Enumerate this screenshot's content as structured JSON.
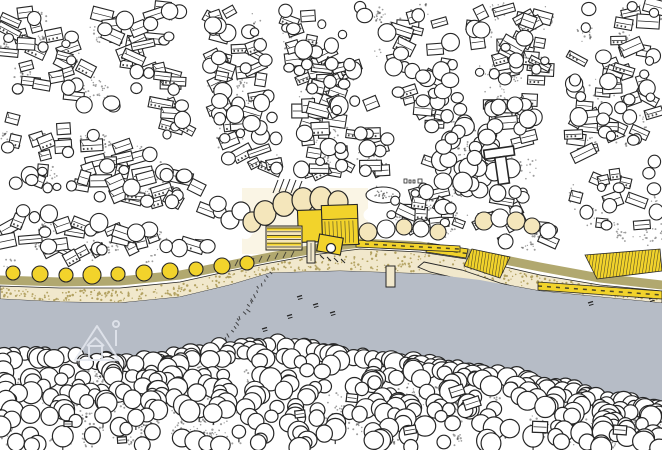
{
  "meta": {
    "width": 662,
    "height": 450,
    "kind": "hand-drawn-riverside-town-map"
  },
  "palette": {
    "ink": "#262626",
    "paper": "#ffffff",
    "river": "#b6bcc6",
    "yellow": "#f2d32b",
    "cream": "#f4e6bb",
    "creamTint": "#f7efd4",
    "sand": "#f1e8cc",
    "sandDot": "#b3a262",
    "olive": "#b1a86f",
    "stipple": "#3c3c3c",
    "street": "#ffffff",
    "watermark": "#e4e8ee"
  },
  "gen": {
    "seed": 11,
    "townBuildings": 300,
    "townTrees": 240,
    "stippleClumps": 160,
    "parkTrees": 26,
    "beachDots": 440,
    "southTrees": 360,
    "southStippleClumps": 95
  },
  "townBottom": [
    [
      0,
      271
    ],
    [
      60,
      271
    ],
    [
      120,
      269
    ],
    [
      180,
      262
    ],
    [
      230,
      253
    ],
    [
      270,
      245
    ],
    [
      320,
      237
    ],
    [
      360,
      233
    ],
    [
      420,
      237
    ],
    [
      480,
      246
    ],
    [
      540,
      258
    ],
    [
      600,
      268
    ],
    [
      662,
      274
    ]
  ],
  "roadPath": [
    [
      0,
      280
    ],
    [
      60,
      282
    ],
    [
      120,
      281
    ],
    [
      180,
      275
    ],
    [
      230,
      265
    ],
    [
      270,
      257
    ],
    [
      320,
      248
    ],
    [
      360,
      243
    ],
    [
      420,
      246
    ],
    [
      480,
      255
    ],
    [
      540,
      267
    ],
    [
      600,
      278
    ],
    [
      662,
      285
    ]
  ],
  "beachTop": [
    [
      0,
      286
    ],
    [
      60,
      288
    ],
    [
      120,
      288
    ],
    [
      180,
      282
    ],
    [
      230,
      271
    ],
    [
      270,
      263
    ],
    [
      320,
      254
    ],
    [
      360,
      249
    ],
    [
      420,
      252
    ],
    [
      480,
      261
    ],
    [
      540,
      275
    ],
    [
      600,
      285
    ],
    [
      662,
      291
    ]
  ],
  "riverTop": [
    [
      0,
      299
    ],
    [
      60,
      302
    ],
    [
      120,
      303
    ],
    [
      180,
      297
    ],
    [
      230,
      285
    ],
    [
      270,
      273
    ],
    [
      340,
      271
    ],
    [
      430,
      274
    ],
    [
      480,
      280
    ],
    [
      540,
      291
    ],
    [
      600,
      297
    ],
    [
      662,
      303
    ]
  ],
  "treeline": [
    [
      0,
      352
    ],
    [
      60,
      356
    ],
    [
      120,
      360
    ],
    [
      180,
      356
    ],
    [
      240,
      343
    ],
    [
      300,
      346
    ],
    [
      360,
      355
    ],
    [
      420,
      362
    ],
    [
      480,
      372
    ],
    [
      540,
      382
    ],
    [
      600,
      394
    ],
    [
      662,
      408
    ]
  ],
  "streets": [
    {
      "pts": [
        [
          0,
          97
        ],
        [
          70,
          112
        ],
        [
          140,
          133
        ],
        [
          200,
          168
        ],
        [
          232,
          202
        ],
        [
          250,
          228
        ]
      ],
      "w": 13
    },
    {
      "pts": [
        [
          0,
          192
        ],
        [
          70,
          205
        ],
        [
          140,
          218
        ],
        [
          200,
          227
        ],
        [
          246,
          233
        ]
      ],
      "w": 12
    },
    {
      "pts": [
        [
          196,
          0
        ],
        [
          190,
          60
        ],
        [
          200,
          120
        ],
        [
          215,
          172
        ],
        [
          232,
          202
        ]
      ],
      "w": 12
    },
    {
      "pts": [
        [
          268,
          0
        ],
        [
          276,
          60
        ],
        [
          284,
          120
        ],
        [
          290,
          165
        ],
        [
          290,
          184
        ]
      ],
      "w": 12
    },
    {
      "pts": [
        [
          338,
          0
        ],
        [
          360,
          45
        ],
        [
          385,
          95
        ],
        [
          412,
          140
        ]
      ],
      "w": 12
    },
    {
      "pts": [
        [
          412,
          140
        ],
        [
          396,
          180
        ],
        [
          380,
          205
        ],
        [
          369,
          215
        ]
      ],
      "w": 11
    },
    {
      "pts": [
        [
          452,
          0
        ],
        [
          462,
          50
        ],
        [
          468,
          95
        ],
        [
          472,
          118
        ]
      ],
      "w": 11
    },
    {
      "pts": [
        [
          572,
          0
        ],
        [
          558,
          75
        ],
        [
          546,
          148
        ],
        [
          547,
          195
        ],
        [
          564,
          225
        ],
        [
          600,
          244
        ],
        [
          640,
          257
        ],
        [
          662,
          262
        ]
      ],
      "w": 13
    },
    {
      "pts": [
        [
          662,
          142
        ],
        [
          618,
          158
        ],
        [
          585,
          170
        ],
        [
          562,
          180
        ]
      ],
      "w": 9
    },
    {
      "pts": [
        [
          612,
          0
        ],
        [
          600,
          40
        ],
        [
          588,
          72
        ]
      ],
      "w": 9
    },
    {
      "pts": [
        [
          62,
          0
        ],
        [
          84,
          40
        ],
        [
          118,
          86
        ],
        [
          146,
          118
        ]
      ],
      "w": 10
    }
  ],
  "park": [
    478,
    160,
    45
  ],
  "rejectRects": [
    [
      230,
      172,
      146,
      100
    ]
  ],
  "steps": [
    [
      278,
      180
    ],
    [
      284,
      179
    ],
    [
      290,
      179
    ],
    [
      296,
      180
    ],
    [
      302,
      181
    ]
  ],
  "hedge": [
    383,
    195,
    17,
    8
  ],
  "plazaObjects": [
    [
      404,
      179,
      3,
      4
    ],
    [
      409,
      180,
      2,
      3
    ],
    [
      413,
      180,
      2,
      3
    ],
    [
      418,
      179,
      4,
      4
    ]
  ],
  "tBuilding": {
    "cx": 501,
    "cy": 166,
    "rot": -8,
    "hbar": [
      -15,
      -18,
      30,
      9
    ],
    "vbar": [
      -5,
      -9,
      11,
      27
    ]
  },
  "roadTicks": [
    [
      238,
      263
    ],
    [
      246,
      262
    ],
    [
      254,
      261
    ],
    [
      262,
      259
    ],
    [
      270,
      258
    ],
    [
      278,
      256
    ],
    [
      286,
      255
    ],
    [
      294,
      254
    ]
  ],
  "groyne": {
    "x1": 268,
    "y1": 272,
    "x2": 214,
    "y2": 356,
    "ticks": 24
  },
  "boatMarks": [
    [
      297,
      297
    ],
    [
      313,
      305
    ],
    [
      330,
      313
    ],
    [
      287,
      316
    ],
    [
      262,
      329
    ],
    [
      637,
      295
    ],
    [
      649,
      299
    ],
    [
      588,
      303
    ]
  ],
  "pontoon": [
    386,
    266,
    9,
    21
  ],
  "sandbar": [
    [
      424,
      262
    ],
    [
      462,
      270
    ],
    [
      500,
      283
    ],
    [
      532,
      291
    ],
    [
      516,
      293
    ],
    [
      468,
      281
    ],
    [
      430,
      272
    ],
    [
      418,
      267
    ]
  ],
  "yellowStrips": [
    {
      "pts": [
        [
          428,
          243
        ],
        [
          468,
          249
        ],
        [
          466,
          258
        ],
        [
          426,
          252
        ]
      ],
      "dash": true
    },
    {
      "pts": [
        [
          472,
          249
        ],
        [
          510,
          257
        ],
        [
          500,
          278
        ],
        [
          464,
          266
        ]
      ],
      "hatch": true
    },
    {
      "pts": [
        [
          585,
          255
        ],
        [
          660,
          249
        ],
        [
          662,
          271
        ],
        [
          597,
          279
        ]
      ],
      "hatch": true
    },
    {
      "pts": [
        [
          538,
          282
        ],
        [
          662,
          291
        ],
        [
          662,
          299
        ],
        [
          538,
          290
        ]
      ],
      "dash": true
    },
    {
      "pts": [
        [
          356,
          240
        ],
        [
          460,
          246
        ],
        [
          460,
          252
        ],
        [
          356,
          247
        ]
      ],
      "dash": true
    }
  ],
  "promTrees": [
    [
      13,
      273,
      7
    ],
    [
      40,
      274,
      8
    ],
    [
      66,
      275,
      7
    ],
    [
      92,
      275,
      9
    ],
    [
      118,
      274,
      7
    ],
    [
      144,
      273,
      8
    ],
    [
      170,
      271,
      8
    ],
    [
      196,
      269,
      7
    ],
    [
      222,
      266,
      8
    ],
    [
      247,
      263,
      7
    ]
  ],
  "shoreTrees": [
    [
      368,
      232,
      9,
      "c"
    ],
    [
      386,
      229,
      9,
      "w"
    ],
    [
      404,
      227,
      8,
      "c"
    ],
    [
      421,
      229,
      8,
      "w"
    ],
    [
      438,
      232,
      8,
      "c"
    ],
    [
      484,
      221,
      9,
      "c"
    ],
    [
      500,
      218,
      9,
      "w"
    ],
    [
      516,
      221,
      9,
      "c"
    ],
    [
      532,
      226,
      8,
      "c"
    ],
    [
      548,
      231,
      8,
      "w"
    ]
  ],
  "complex": {
    "tint": [
      242,
      188,
      126,
      66
    ],
    "creamTrees": [
      [
        252,
        222,
        9
      ],
      [
        265,
        213,
        11
      ],
      [
        284,
        204,
        11
      ],
      [
        303,
        200,
        11
      ],
      [
        321,
        199,
        11
      ],
      [
        338,
        202,
        10
      ]
    ],
    "whiteTrees": [
      [
        230,
        220,
        9
      ],
      [
        241,
        211,
        9
      ]
    ],
    "annex": [
      298,
      210,
      26,
      32,
      -2
    ],
    "main": [
      322,
      205,
      36,
      40,
      -2
    ],
    "terraces": [
      266,
      226,
      36,
      24
    ],
    "pier": [
      307,
      241,
      8,
      22
    ],
    "dock": [
      318,
      236,
      24,
      17,
      10
    ],
    "wheel": [
      331,
      248,
      4.5
    ],
    "dockHatch": [
      [
        320,
        255
      ],
      [
        327,
        257
      ],
      [
        334,
        258
      ],
      [
        341,
        259
      ]
    ]
  },
  "southBuildings": [
    [
      457,
      391,
      14,
      10,
      -18
    ],
    [
      472,
      403,
      16,
      10,
      -18
    ],
    [
      352,
      398,
      11,
      8,
      6
    ],
    [
      540,
      427,
      15,
      11,
      2
    ],
    [
      300,
      414,
      10,
      7,
      -6
    ],
    [
      68,
      424,
      8,
      5,
      0
    ],
    [
      122,
      440,
      9,
      6,
      -4
    ],
    [
      410,
      430,
      12,
      8,
      -10
    ],
    [
      620,
      430,
      13,
      9,
      4
    ]
  ],
  "watermark": {
    "triangle": [
      [
        75,
        360
      ],
      [
        97,
        326
      ],
      [
        119,
        360
      ]
    ],
    "house": [
      89,
      346,
      13,
      14
    ],
    "houseRoof": [
      [
        87,
        346
      ],
      [
        95.5,
        338
      ],
      [
        104,
        346
      ]
    ],
    "flagLine": [
      [
        116,
        330
      ],
      [
        116,
        346
      ]
    ],
    "flagDot": [
      116,
      324,
      3
    ]
  }
}
